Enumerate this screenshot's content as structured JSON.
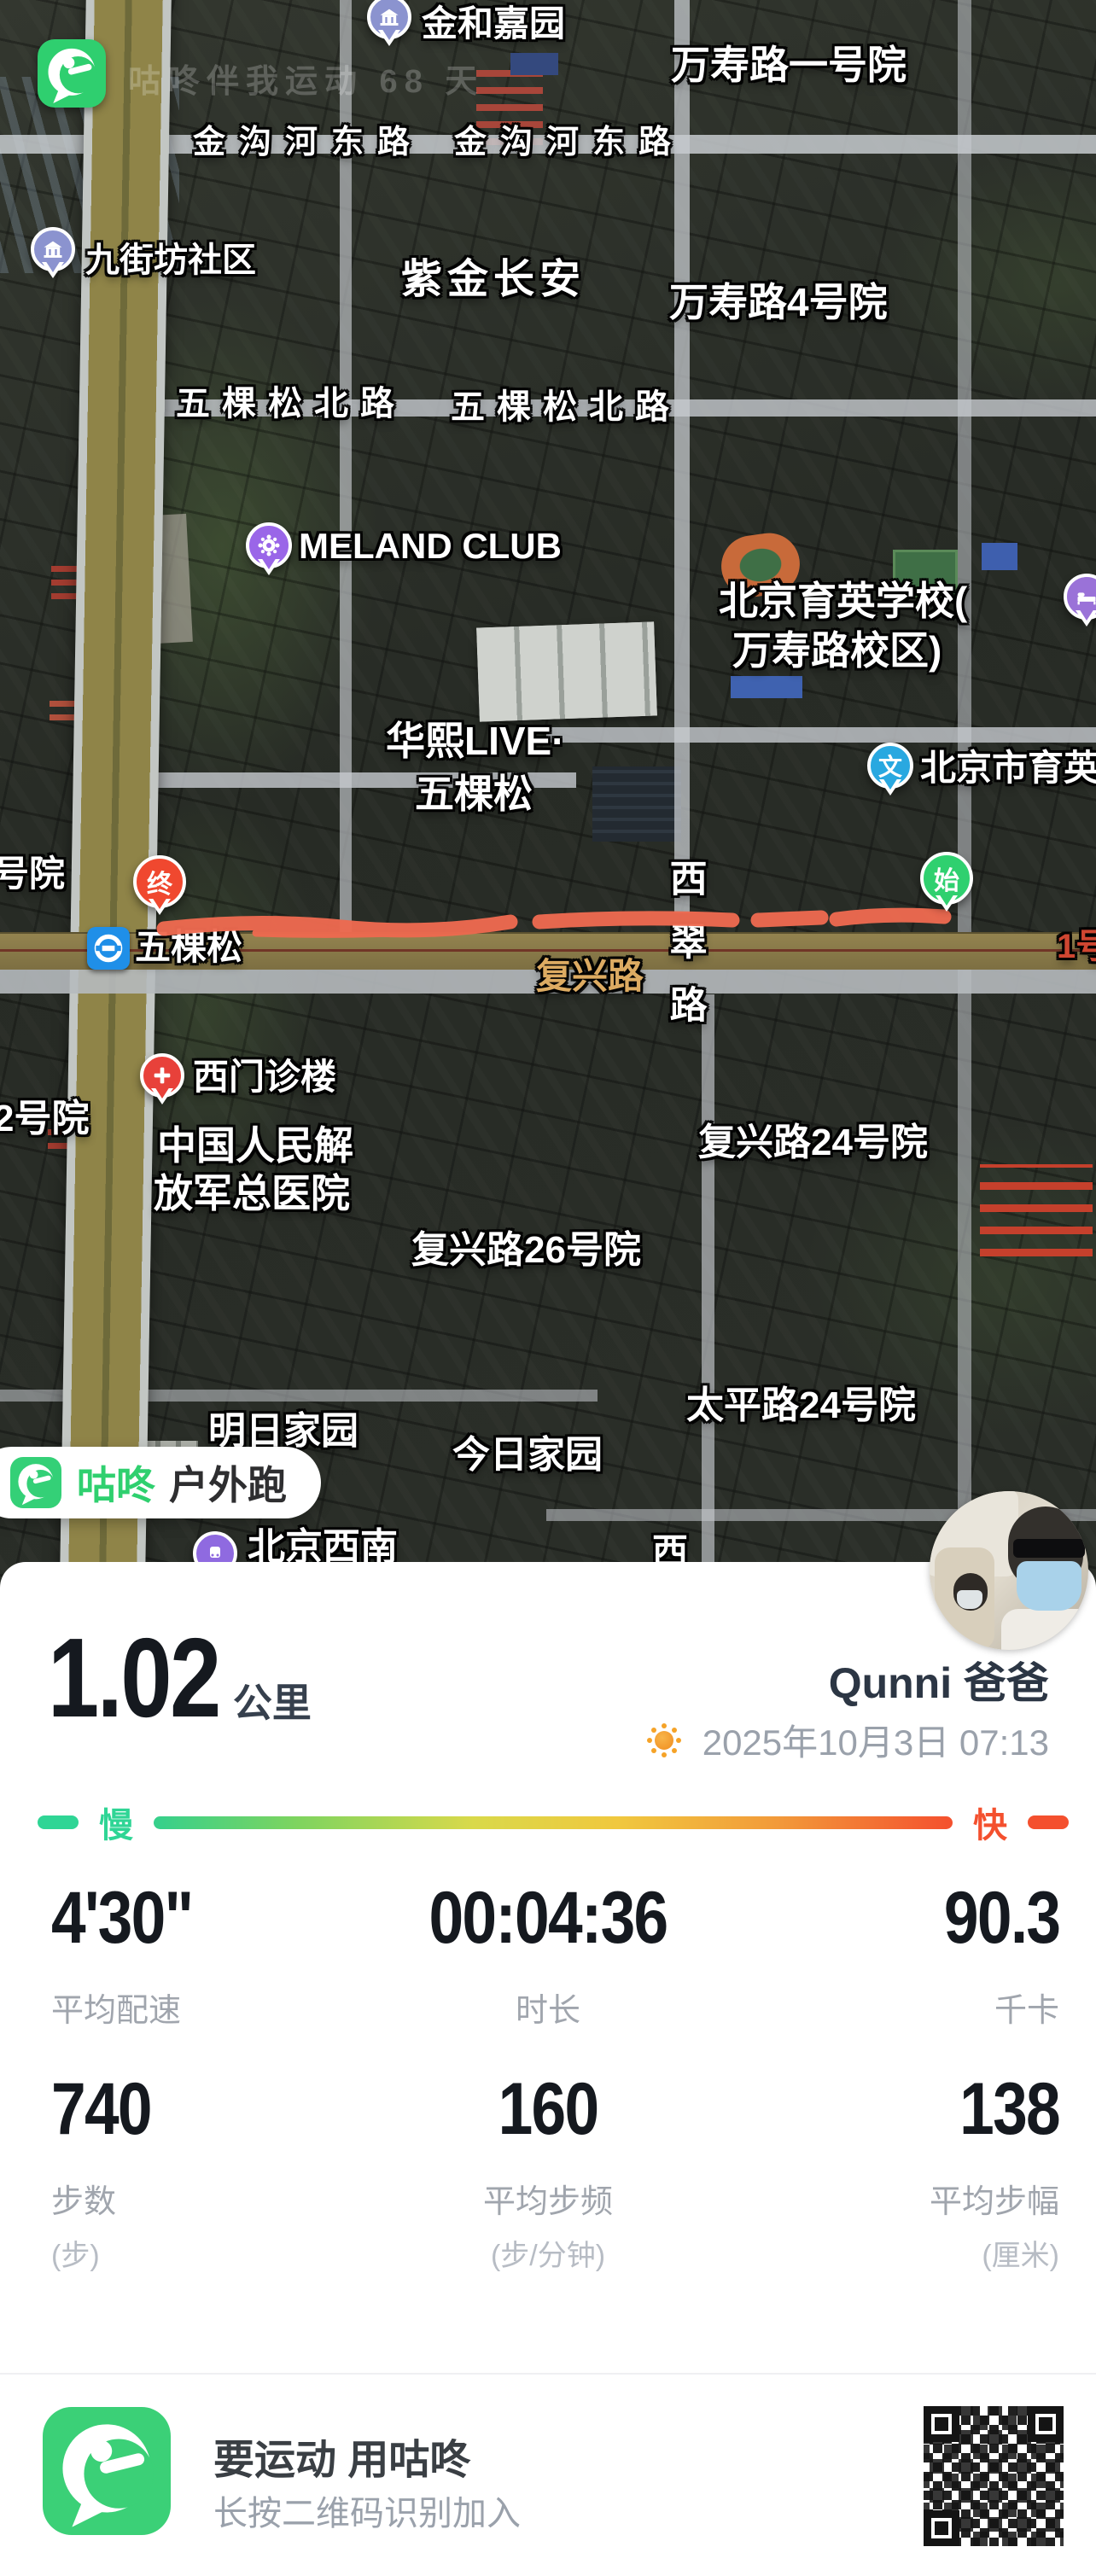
{
  "colors": {
    "brand_green": "#34d077",
    "route_red": "#ee6a50",
    "slow_green": "#2fd595",
    "fast_red": "#f4502e",
    "sun_orange": "#f5a328"
  },
  "map": {
    "watermark": "咕咚伴我运动 68 天",
    "labels": {
      "jinhe_jiayuan": "金和嘉园",
      "wanshoulu_yihaoyuan": "万寿路一号院",
      "jingouhe_donglu_1": "金沟河东路",
      "jingouhe_donglu_2": "金沟河东路",
      "jiujiefang_shequ": "九街坊社区",
      "zijin_changan": "紫金长安",
      "wanshoulu_4haoyuan": "万寿路4号院",
      "wukesong_beilu_1": "五棵松北路",
      "wukesong_beilu_2": "五棵松北路",
      "meland_club": "MELAND CLUB",
      "yuying_school_line1": "北京育英学校(",
      "yuying_school_line2": "万寿路校区)",
      "huaxi_live_line1": "华熙LIVE·",
      "huaxi_live_line2": "五棵松",
      "yuying_middle": "北京市育英中",
      "haoyuan_partial": "号院",
      "wukesong_station": "五棵松",
      "fuxinglu": "复兴路",
      "line_1": "1号",
      "xicui_lu": "西翠路",
      "ximen_zhenlou": "西门诊楼",
      "erhaoyuan_partial": "2号院",
      "hospital_line1": "中国人民解",
      "hospital_line2": "放军总医院",
      "fuxinglu_24": "复兴路24号院",
      "fuxinglu_26": "复兴路26号院",
      "mingri_jiayuan": "明日家园",
      "jinri_jiayuan": "今日家园",
      "taipinglu_24": "太平路24号院",
      "beijing_xinan": "北京西南",
      "xi_partial": "西"
    },
    "pins": {
      "end": "终",
      "start": "始",
      "school": "文"
    },
    "badge": {
      "app_name": "咕咚",
      "activity": "户外跑"
    }
  },
  "summary": {
    "distance_value": "1.02",
    "distance_unit": "公里",
    "user_name": "Qunni 爸爸",
    "datetime": "2025年10月3日 07:13",
    "pace_slow_label": "慢",
    "pace_fast_label": "快"
  },
  "stats": {
    "row1": [
      {
        "value": "4'30\"",
        "label": "平均配速"
      },
      {
        "value": "00:04:36",
        "label": "时长"
      },
      {
        "value": "90.3",
        "label": "千卡"
      }
    ],
    "row2": [
      {
        "value": "740",
        "label": "步数",
        "sub": "(步)"
      },
      {
        "value": "160",
        "label": "平均步频",
        "sub": "(步/分钟)"
      },
      {
        "value": "138",
        "label": "平均步幅",
        "sub": "(厘米)"
      }
    ]
  },
  "footer": {
    "title": "要运动 用咕咚",
    "subtitle": "长按二维码识别加入"
  }
}
